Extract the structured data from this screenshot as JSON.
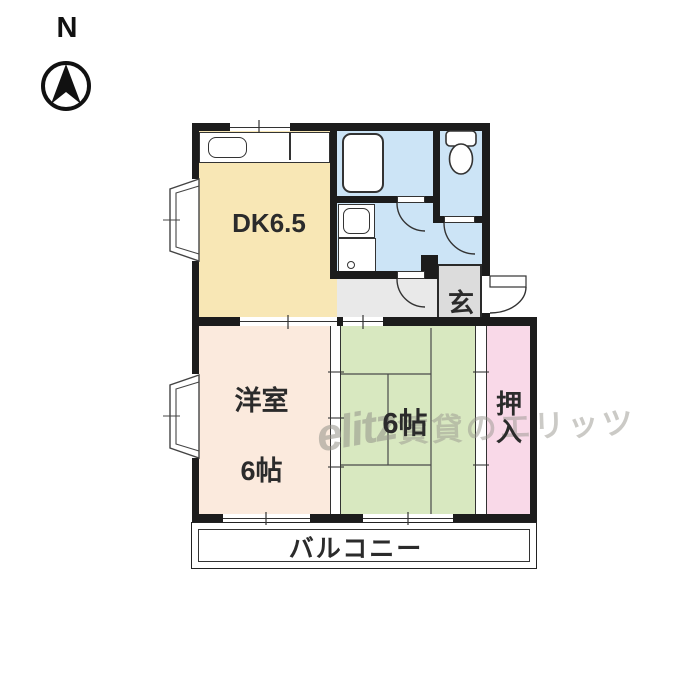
{
  "compass": {
    "north_label": "N"
  },
  "rooms": {
    "dining_kitchen": {
      "label": "DK6.5"
    },
    "western_room": {
      "label_line1": "洋室",
      "label_line2": "6帖"
    },
    "tatami_room": {
      "label": "6帖"
    },
    "closet": {
      "label": "押入"
    },
    "entrance": {
      "label": "玄"
    },
    "balcony": {
      "label": "バルコニー"
    }
  },
  "watermark": {
    "logo": "elitz",
    "text": "賃貸のエリッツ"
  },
  "colors": {
    "wall": "#1C1C1C",
    "dk_floor": "#F8E7B5",
    "wet_area_floor": "#CCE4F6",
    "western_room_floor": "#FBEADD",
    "tatami_floor": "#D8E8C0",
    "closet_floor": "#F9D9E8",
    "entrance_floor": "#DCDCDC",
    "hallway_floor": "#E9E9E9"
  }
}
